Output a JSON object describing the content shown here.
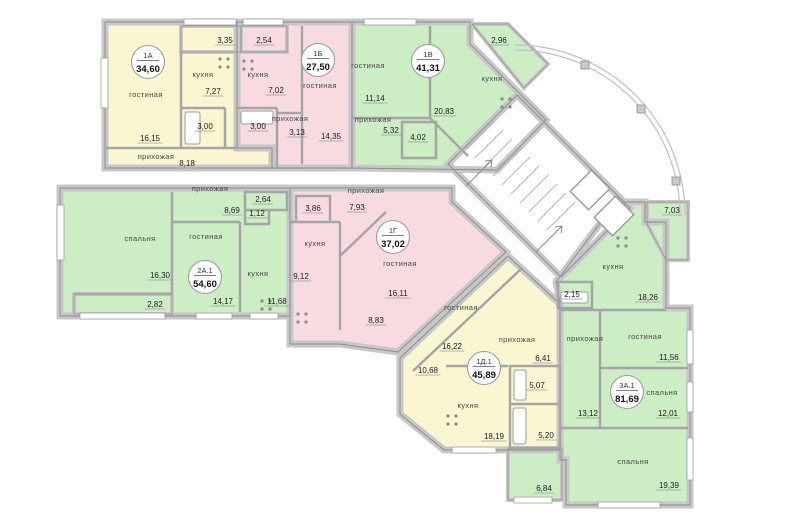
{
  "plan": {
    "colors": {
      "yellow": "#FAF6D2",
      "pink": "#F8DBE1",
      "green": "#CDEDC5",
      "wall": "#c7c7c7",
      "wall_edge": "#8a8a8a"
    },
    "units": [
      {
        "id": "1А",
        "area": "34,60",
        "color": "yellow",
        "badge": {
          "x": 148,
          "y": 62
        },
        "rooms": [
          {
            "label": "гостиная",
            "x": 146,
            "y": 97
          },
          {
            "label": "кухня",
            "x": 203,
            "y": 77
          },
          {
            "label": "прихожая",
            "x": 156,
            "y": 159
          }
        ],
        "dims": [
          {
            "v": "16,15",
            "x": 150,
            "y": 141
          },
          {
            "v": "7,27",
            "x": 213,
            "y": 94
          },
          {
            "v": "3,00",
            "x": 205,
            "y": 129
          },
          {
            "v": "8,18",
            "x": 187,
            "y": 166
          },
          {
            "v": "3,35",
            "x": 225,
            "y": 43
          }
        ]
      },
      {
        "id": "1Б",
        "area": "27,50",
        "color": "pink",
        "badge": {
          "x": 318,
          "y": 60
        },
        "rooms": [
          {
            "label": "гостиная",
            "x": 320,
            "y": 88
          },
          {
            "label": "кухня",
            "x": 258,
            "y": 77
          },
          {
            "label": "прихожая",
            "x": 290,
            "y": 121
          }
        ],
        "dims": [
          {
            "v": "14,35",
            "x": 331,
            "y": 139
          },
          {
            "v": "7,02",
            "x": 276,
            "y": 93
          },
          {
            "v": "3,00",
            "x": 258,
            "y": 129
          },
          {
            "v": "3,13",
            "x": 297,
            "y": 135
          },
          {
            "v": "2,54",
            "x": 264,
            "y": 43
          }
        ]
      },
      {
        "id": "1В",
        "area": "41,31",
        "color": "green",
        "badge": {
          "x": 428,
          "y": 61
        },
        "rooms": [
          {
            "label": "гостиная",
            "x": 368,
            "y": 68
          },
          {
            "label": "кухня",
            "x": 492,
            "y": 81
          },
          {
            "label": "прихожая",
            "x": 373,
            "y": 122
          }
        ],
        "dims": [
          {
            "v": "11,14",
            "x": 375,
            "y": 101
          },
          {
            "v": "20,83",
            "x": 444,
            "y": 114
          },
          {
            "v": "5,32",
            "x": 391,
            "y": 133
          },
          {
            "v": "4,02",
            "x": 418,
            "y": 140
          },
          {
            "v": "2,96",
            "x": 499,
            "y": 43
          }
        ]
      },
      {
        "id": "2А.1",
        "area": "54,60",
        "color": "green",
        "badge": {
          "x": 205,
          "y": 277
        },
        "rooms": [
          {
            "label": "спальня",
            "x": 140,
            "y": 241
          },
          {
            "label": "гостиная",
            "x": 206,
            "y": 239
          },
          {
            "label": "кухня",
            "x": 258,
            "y": 276
          },
          {
            "label": "прихожая",
            "x": 210,
            "y": 191
          }
        ],
        "dims": [
          {
            "v": "16,30",
            "x": 160,
            "y": 278
          },
          {
            "v": "14,17",
            "x": 223,
            "y": 304
          },
          {
            "v": "11,68",
            "x": 277,
            "y": 304
          },
          {
            "v": "8,69",
            "x": 232,
            "y": 213
          },
          {
            "v": "2,64",
            "x": 263,
            "y": 202
          },
          {
            "v": "1,12",
            "x": 257,
            "y": 216
          },
          {
            "v": "2,82",
            "x": 155,
            "y": 307
          }
        ]
      },
      {
        "id": "1Г",
        "area": "37,02",
        "color": "pink",
        "badge": {
          "x": 393,
          "y": 237
        },
        "rooms": [
          {
            "label": "гостиная",
            "x": 400,
            "y": 266
          },
          {
            "label": "кухня",
            "x": 315,
            "y": 246
          },
          {
            "label": "прихожая",
            "x": 366,
            "y": 193
          }
        ],
        "dims": [
          {
            "v": "16,11",
            "x": 398,
            "y": 296
          },
          {
            "v": "9,12",
            "x": 301,
            "y": 279
          },
          {
            "v": "7,93",
            "x": 357,
            "y": 210
          },
          {
            "v": "3,86",
            "x": 313,
            "y": 211
          },
          {
            "v": "8,83",
            "x": 376,
            "y": 323
          }
        ]
      },
      {
        "id": "1Д.1",
        "area": "45,89",
        "color": "yellow",
        "badge": {
          "x": 484,
          "y": 368
        },
        "rooms": [
          {
            "label": "гостиная",
            "x": 461,
            "y": 310
          },
          {
            "label": "кухня",
            "x": 468,
            "y": 408
          },
          {
            "label": "прихожая",
            "x": 517,
            "y": 342
          }
        ],
        "dims": [
          {
            "v": "16,22",
            "x": 452,
            "y": 349
          },
          {
            "v": "18,19",
            "x": 494,
            "y": 439
          },
          {
            "v": "6,41",
            "x": 543,
            "y": 361
          },
          {
            "v": "5,07",
            "x": 537,
            "y": 388
          },
          {
            "v": "5,20",
            "x": 546,
            "y": 438
          },
          {
            "v": "10,68",
            "x": 428,
            "y": 373
          }
        ]
      },
      {
        "id": "3А.1",
        "area": "81,69",
        "color": "green",
        "badge": {
          "x": 627,
          "y": 392
        },
        "rooms": [
          {
            "label": "гостиная",
            "x": 645,
            "y": 339
          },
          {
            "label": "спальня",
            "x": 662,
            "y": 395
          },
          {
            "label": "спальня",
            "x": 633,
            "y": 464
          },
          {
            "label": "кухня",
            "x": 613,
            "y": 269
          },
          {
            "label": "прихожая",
            "x": 585,
            "y": 341
          }
        ],
        "dims": [
          {
            "v": "11,56",
            "x": 669,
            "y": 360
          },
          {
            "v": "12,01",
            "x": 668,
            "y": 416
          },
          {
            "v": "19,39",
            "x": 669,
            "y": 488
          },
          {
            "v": "18,26",
            "x": 648,
            "y": 300
          },
          {
            "v": "13,12",
            "x": 588,
            "y": 416
          },
          {
            "v": "2,15",
            "x": 572,
            "y": 297
          },
          {
            "v": "7,03",
            "x": 672,
            "y": 213
          },
          {
            "v": "6,84",
            "x": 544,
            "y": 491
          }
        ]
      }
    ]
  }
}
